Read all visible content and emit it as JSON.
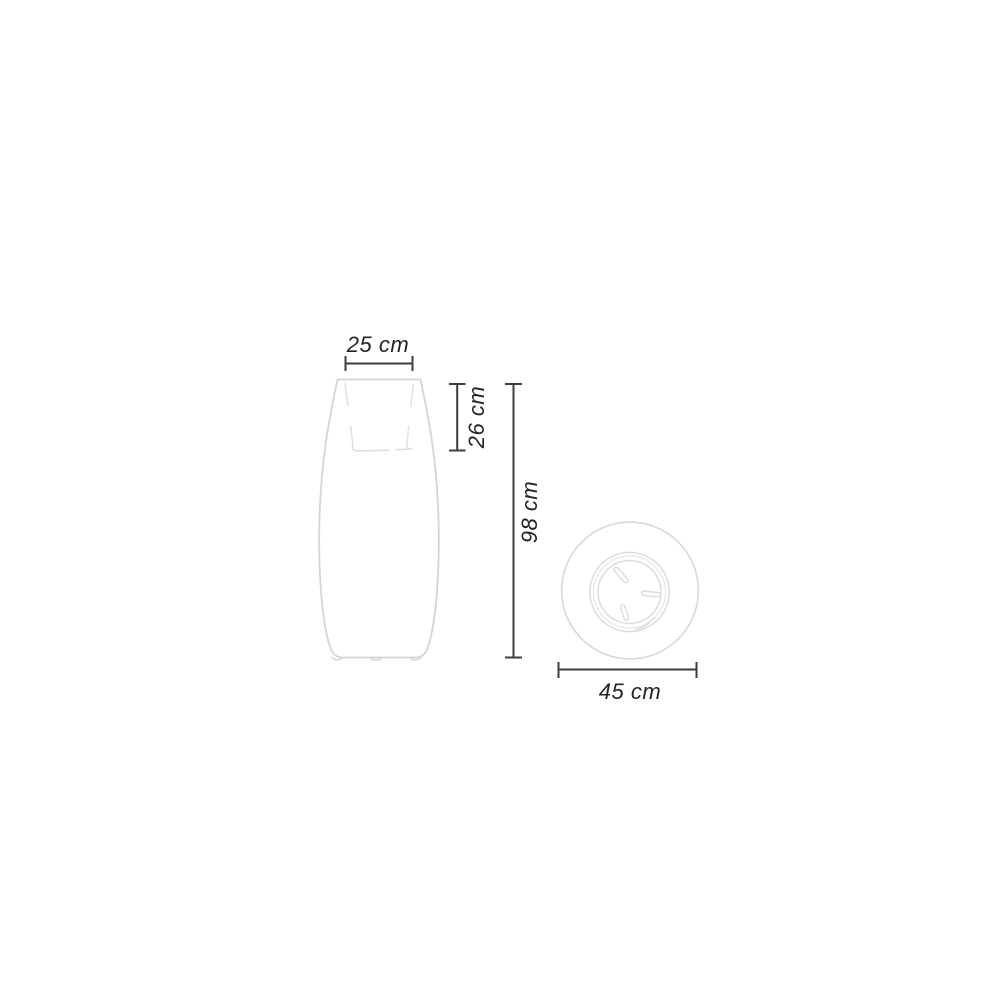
{
  "diagram": {
    "kind": "product-dimension-drawing",
    "dimensions": {
      "opening_width": "25 cm",
      "inner_depth": "26 cm",
      "total_height": "98 cm",
      "diameter": "45 cm"
    },
    "colors": {
      "background": "#ffffff",
      "product_outline": "#d5d5d5",
      "product_inner_line": "#e3e3e3",
      "dimension_line": "#3d3d3d",
      "dimension_text": "#242424"
    }
  }
}
